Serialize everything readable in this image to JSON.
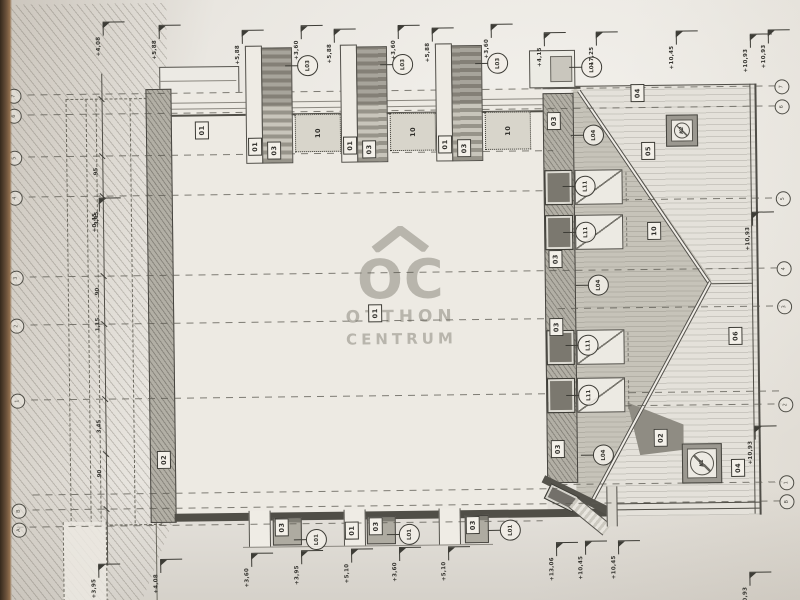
{
  "watermark": {
    "logo": "OC",
    "line1": "OTTHON",
    "line2": "CENTRUM"
  },
  "grid_rows": [
    {
      "y": 90,
      "x1": 30,
      "x2": 780
    },
    {
      "y": 110,
      "x1": 30,
      "x2": 780
    },
    {
      "y": 152,
      "x1": 30,
      "x2": 555
    },
    {
      "y": 192,
      "x1": 30,
      "x2": 555
    },
    {
      "y": 202,
      "x1": 558,
      "x2": 780
    },
    {
      "y": 272,
      "x1": 30,
      "x2": 780
    },
    {
      "y": 310,
      "x1": 558,
      "x2": 780
    },
    {
      "y": 320,
      "x1": 30,
      "x2": 555
    },
    {
      "y": 395,
      "x1": 30,
      "x2": 780
    },
    {
      "y": 408,
      "x1": 558,
      "x2": 780
    },
    {
      "y": 486,
      "x1": 558,
      "x2": 780
    },
    {
      "y": 490,
      "x1": 30,
      "x2": 555
    },
    {
      "y": 505,
      "x1": 30,
      "x2": 780
    },
    {
      "y": 522,
      "x1": 14,
      "x2": 540
    }
  ],
  "grid_bubbles": {
    "left": [
      {
        "id": "7",
        "y": 84
      },
      {
        "id": "6",
        "y": 104
      },
      {
        "id": "5",
        "y": 146
      },
      {
        "id": "4",
        "y": 186
      },
      {
        "id": "3",
        "y": 266
      },
      {
        "id": "2",
        "y": 314
      },
      {
        "id": "1",
        "y": 389
      },
      {
        "id": "B",
        "y": 499
      },
      {
        "id": "A",
        "y": 518
      }
    ],
    "right": [
      {
        "id": "7",
        "y": 84
      },
      {
        "id": "6",
        "y": 104
      },
      {
        "id": "5",
        "y": 196
      },
      {
        "id": "4",
        "y": 266
      },
      {
        "id": "3",
        "y": 304
      },
      {
        "id": "2",
        "y": 402
      },
      {
        "id": "1",
        "y": 480
      },
      {
        "id": "B",
        "y": 499
      }
    ]
  },
  "boxes": [
    {
      "label": "01",
      "x": 197,
      "y": 119
    },
    {
      "label": "01",
      "x": 368,
      "y": 304
    },
    {
      "label": "02",
      "x": 155,
      "y": 448
    },
    {
      "label": "03",
      "x": 549,
      "y": 114
    },
    {
      "label": "03",
      "x": 549,
      "y": 252
    },
    {
      "label": "03",
      "x": 549,
      "y": 320
    },
    {
      "label": "03",
      "x": 549,
      "y": 442
    },
    {
      "label": "04",
      "x": 633,
      "y": 87
    },
    {
      "label": "05",
      "x": 643,
      "y": 145
    },
    {
      "label": "10",
      "x": 648,
      "y": 225
    },
    {
      "label": "06",
      "x": 728,
      "y": 331
    },
    {
      "label": "02",
      "x": 652,
      "y": 432
    },
    {
      "label": "04",
      "x": 729,
      "y": 463
    },
    {
      "label": "03",
      "x": 272,
      "y": 517
    },
    {
      "label": "01",
      "x": 342,
      "y": 521
    },
    {
      "label": "03",
      "x": 366,
      "y": 517
    },
    {
      "label": "03",
      "x": 463,
      "y": 517
    }
  ],
  "dormers": {
    "xs": [
      248,
      343,
      438
    ],
    "labels": {
      "bar": "01",
      "band": "03",
      "attic": "10",
      "tag": "L03"
    }
  },
  "right_windows": {
    "ys": [
      172,
      217,
      332,
      380
    ]
  },
  "tags": [
    {
      "label": "L01",
      "x": 584,
      "y": 59
    },
    {
      "label": "L04",
      "x": 585,
      "y": 127
    },
    {
      "label": "L04",
      "x": 588,
      "y": 277
    },
    {
      "label": "L04",
      "x": 591,
      "y": 447
    },
    {
      "label": "L11",
      "x": 576,
      "y": 178
    },
    {
      "label": "L11",
      "x": 576,
      "y": 224
    },
    {
      "label": "L11",
      "x": 577,
      "y": 337
    },
    {
      "label": "L11",
      "x": 577,
      "y": 387
    },
    {
      "label": "L01",
      "x": 303,
      "y": 528
    },
    {
      "label": "L01",
      "x": 396,
      "y": 524
    },
    {
      "label": "L01",
      "x": 497,
      "y": 521
    }
  ],
  "chimneys": [
    {
      "label": "K2",
      "x": 668,
      "y": 118,
      "size": 30
    },
    {
      "label": "K1",
      "x": 680,
      "y": 447,
      "size": 38
    }
  ],
  "flags": [
    {
      "text": "+5,88",
      "x": 243,
      "y": 28
    },
    {
      "text": "+3,60",
      "x": 302,
      "y": 24
    },
    {
      "text": "+5,88",
      "x": 335,
      "y": 28
    },
    {
      "text": "+3,60",
      "x": 399,
      "y": 25
    },
    {
      "text": "+5,88",
      "x": 433,
      "y": 28
    },
    {
      "text": "+3,60",
      "x": 492,
      "y": 25
    },
    {
      "text": "+4,15",
      "x": 545,
      "y": 34
    },
    {
      "text": "+7,25",
      "x": 597,
      "y": 34
    },
    {
      "text": "+10,45",
      "x": 677,
      "y": 34
    },
    {
      "text": "+10,93",
      "x": 769,
      "y": 34
    },
    {
      "text": "+4,08",
      "x": 104,
      "y": 18
    },
    {
      "text": "+5,88",
      "x": 160,
      "y": 22
    },
    {
      "text": "+0,45",
      "x": 98,
      "y": 194
    },
    {
      "text": "+3,95",
      "x": 93,
      "y": 560
    },
    {
      "text": "+4,08",
      "x": 155,
      "y": 556
    },
    {
      "text": "+3,60",
      "x": 246,
      "y": 551
    },
    {
      "text": "+3,95",
      "x": 296,
      "y": 549
    },
    {
      "text": "+5,10",
      "x": 346,
      "y": 548
    },
    {
      "text": "+3,60",
      "x": 394,
      "y": 547
    },
    {
      "text": "+5,10",
      "x": 443,
      "y": 547
    },
    {
      "text": "+13,06",
      "x": 551,
      "y": 544
    },
    {
      "text": "+10,45",
      "x": 580,
      "y": 543
    },
    {
      "text": "+10,45",
      "x": 613,
      "y": 543
    },
    {
      "text": "+10,93",
      "x": 751,
      "y": 38
    },
    {
      "text": "+10,93",
      "x": 751,
      "y": 216
    },
    {
      "text": "+10,93",
      "x": 751,
      "y": 430
    },
    {
      "text": "+10,93",
      "x": 744,
      "y": 576
    }
  ],
  "dim_chain": {
    "line_x": 104,
    "ticks": [
      95,
      152,
      192,
      272,
      320,
      395,
      450,
      505
    ],
    "numbers": [
      {
        "v": "95",
        "y": 164
      },
      {
        "v": "3,45",
        "y": 208
      },
      {
        "v": "90",
        "y": 284
      },
      {
        "v": "1,15",
        "y": 314
      },
      {
        "v": "3,45",
        "y": 416
      },
      {
        "v": "90",
        "y": 466
      }
    ]
  }
}
